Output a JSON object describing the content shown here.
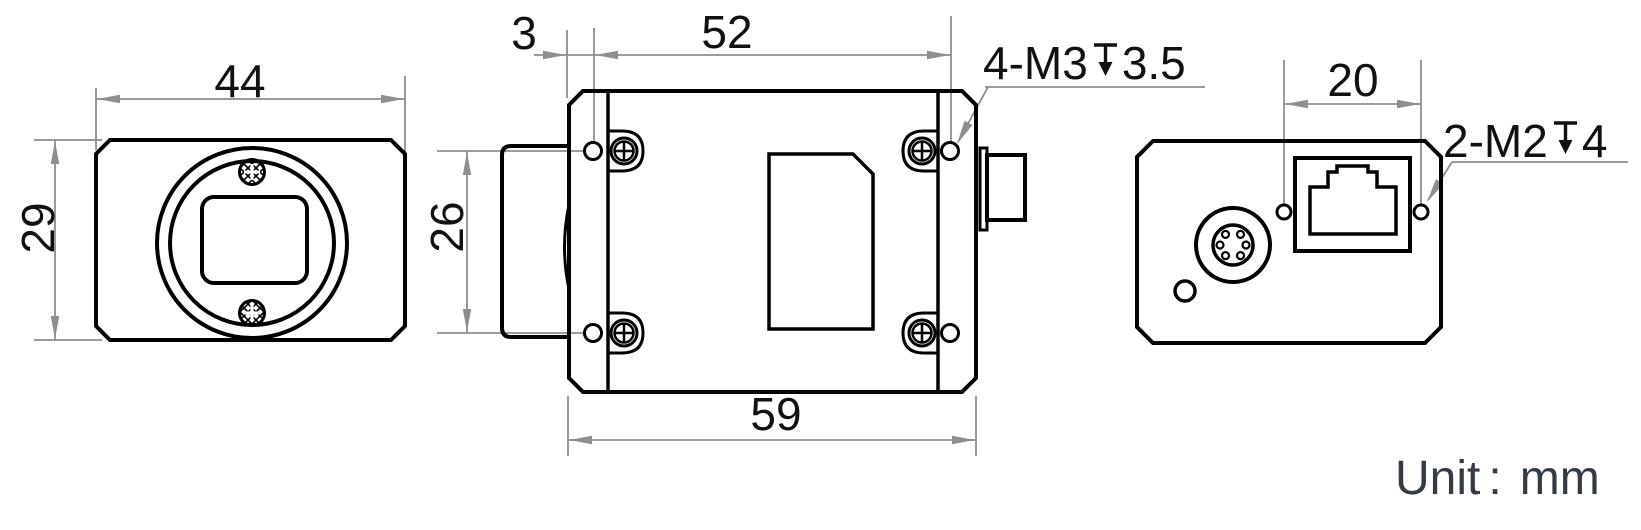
{
  "front_view": {
    "width_dim": "44",
    "height_dim": "29"
  },
  "top_view": {
    "edge_offset_dim": "3",
    "hole_pitch_length_dim": "52",
    "hole_pitch_width_dim": "26",
    "body_length_dim": "59",
    "thread_note": {
      "prefix": "4-M3",
      "depth_value": "3.5",
      "full_text": "4-M3↧3.5"
    }
  },
  "back_view": {
    "hole_pitch_dim": "20",
    "thread_note": {
      "prefix": "2-M2",
      "depth_value": "4",
      "full_text": "2-M2↧4"
    }
  },
  "unit_note": {
    "label": "Unit",
    "colon": ":",
    "value": "mm"
  },
  "colors": {
    "outline": "#000000",
    "dimension_line": "#8e8e8e",
    "dimension_text": "#111111",
    "unit_text": "#333b45",
    "background": "#ffffff"
  }
}
